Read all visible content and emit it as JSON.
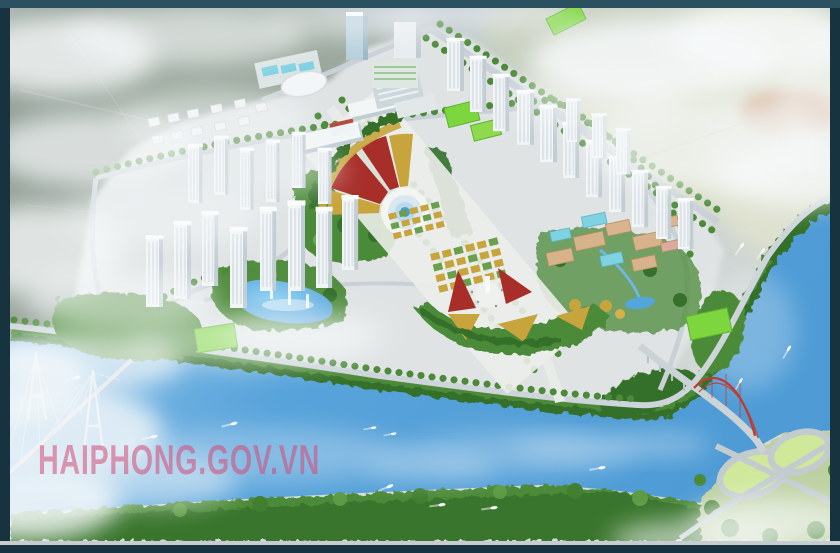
{
  "watermark": {
    "text": "HAIPHONG.GOV.VN"
  },
  "palette": {
    "frame_top": "#2b5060",
    "frame_side": "#16333f",
    "bottom_line": "#c7ccd1",
    "haze": "#f5f7f8",
    "terrain_nw": "#8e9b91",
    "terrain_ne": "#d5dabe",
    "terrain_salmon": "#d7ae92",
    "city_ground": "#dfe3e4",
    "road": "#c9d1d6",
    "axis_road": "#e9ebe8",
    "river_main": "#4e9bd5",
    "river_light": "#9ecdee",
    "foliage_dark": "#35702c",
    "foliage_mid": "#4c8a39",
    "foliage_light": "#68aa4f",
    "lawn": "#7ed63f",
    "loop_lawn": "#cfe89a",
    "plaza": "#ecedea",
    "flower_red": "#a82e2a",
    "flower_gold": "#c8a43c",
    "building_face": "#f2f5f6",
    "building_side": "#c2ccd3",
    "campus_tan": "#d7b38c",
    "roof_cyan": "#7fd2e2",
    "pond_blue": "#53a6da",
    "bridge_red": "#c23a2e",
    "watermark": "#d34b77"
  }
}
